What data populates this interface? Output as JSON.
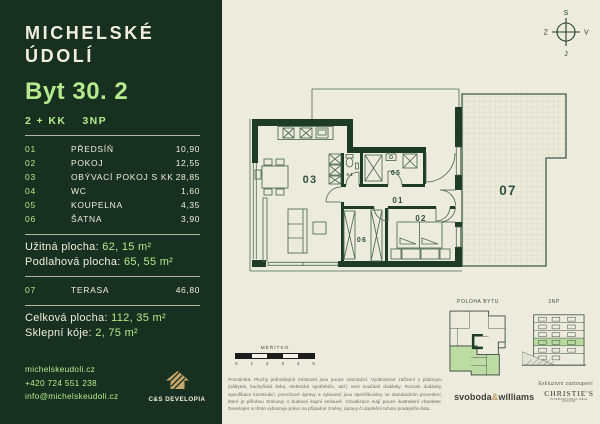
{
  "colors": {
    "sidebar_bg": "#18301f",
    "accent_green": "#b4ea8d",
    "cream": "#efede0",
    "wall_green": "#1e3b28",
    "page_bg": "#edebdd",
    "gold": "#c7a76b",
    "highlight_green": "#b8d99e"
  },
  "sidebar": {
    "logo_line1": "MICHELSKÉ",
    "logo_line2": "ÚDOLÍ",
    "unit_title": "Byt 30. 2",
    "layout": "2 + KK",
    "floor": "3NP",
    "rooms": [
      {
        "num": "01",
        "name": "PŘEDSÍŇ",
        "area": "10,90"
      },
      {
        "num": "02",
        "name": "POKOJ",
        "area": "12,55"
      },
      {
        "num": "03",
        "name": "OBÝVACÍ POKOJ S KK",
        "area": "28,85"
      },
      {
        "num": "04",
        "name": "WC",
        "area": "1,60"
      },
      {
        "num": "05",
        "name": "KOUPELNA",
        "area": "4,35"
      },
      {
        "num": "06",
        "name": "ŠATNA",
        "area": "3,90"
      }
    ],
    "usable_label": "Užitná plocha:",
    "usable_value": "62, 15 m²",
    "floor_area_label": "Podlahová plocha:",
    "floor_area_value": "65, 55 m²",
    "terrace": {
      "num": "07",
      "name": "TERASA",
      "area": "46,80"
    },
    "total_label": "Celková plocha:",
    "total_value": "112, 35 m²",
    "cellar_label": "Sklepní kóje:",
    "cellar_value": "2, 75 m²",
    "contact": {
      "web": "michelskeudoli.cz",
      "phone": "+420 724 551 238",
      "email": "info@michelskeudoli.cz"
    },
    "developer_logo": "C&S DEVELOPIA"
  },
  "plan": {
    "compass": {
      "n": "S",
      "e": "V",
      "s": "J",
      "w": "Z"
    },
    "labels": {
      "r01": "01",
      "r02": "02",
      "r03": "03",
      "r04": "04",
      "r05": "05",
      "r06": "06",
      "r07": "07"
    },
    "scale": {
      "title": "MĚŘÍTKO",
      "ticks": [
        "0",
        "1",
        "2",
        "3",
        "4",
        "5"
      ]
    },
    "notes": "Poznámka: Plochy jednotlivých místností jsou pouze orientační. Vyobrazené zařízení v půdorysu (nábytek, kuchyňská linka, elektrické spotřebiče, atd.) není součástí dodávky. Rozsah dodávky, specifikace konstrukcí, povrchové úpravy a vybavení jsou specifikovány ve standardním provedení, které je přílohou Smlouvy o budoucí kupní smlouvě. Vizualizace mají pouze ilustrativní charakter. Developer si tímto vyhrazuje právo na případné změny, úpravy či doplnění tohoto prodejního listu."
  },
  "minimap": {
    "position_label": "POLOHA BYTU",
    "floor_label": "3NP",
    "exclusive_label": "Exkluzivní zastoupení",
    "agency1_a": "svoboda",
    "agency1_amp": "&",
    "agency1_b": "williams",
    "agency2": "CHRISTIE'S",
    "agency2_sub": "INTERNATIONAL REAL ESTATE"
  }
}
